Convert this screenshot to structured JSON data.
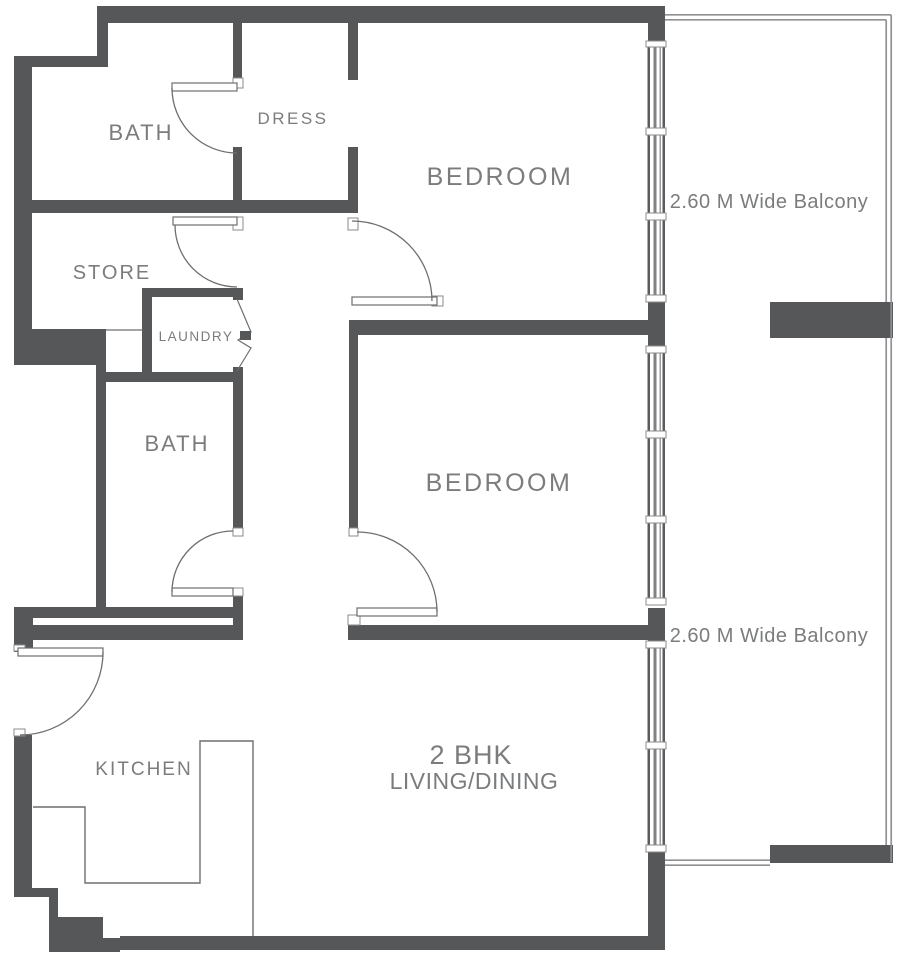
{
  "floor_plan": {
    "unit_type_label": "2 BHK",
    "labels": {
      "bath_1": "BATH",
      "dress": "DRESS",
      "bedroom_1": "BEDROOM",
      "balcony_1": "2.60 M Wide Balcony",
      "store": "STORE",
      "laundry": "LAUNDRY",
      "bath_2": "BATH",
      "bedroom_2": "BEDROOM",
      "kitchen": "KITCHEN",
      "living_dining": "LIVING/DINING",
      "balcony_2": "2.60 M Wide Balcony"
    },
    "colors": {
      "wall": "#565759",
      "line": "#6d6e70",
      "text": "#7b7c7e",
      "window_mid": "#808285",
      "parapet": "#8f9194",
      "sill_border": "#8a8c8e",
      "background": "#ffffff"
    }
  }
}
